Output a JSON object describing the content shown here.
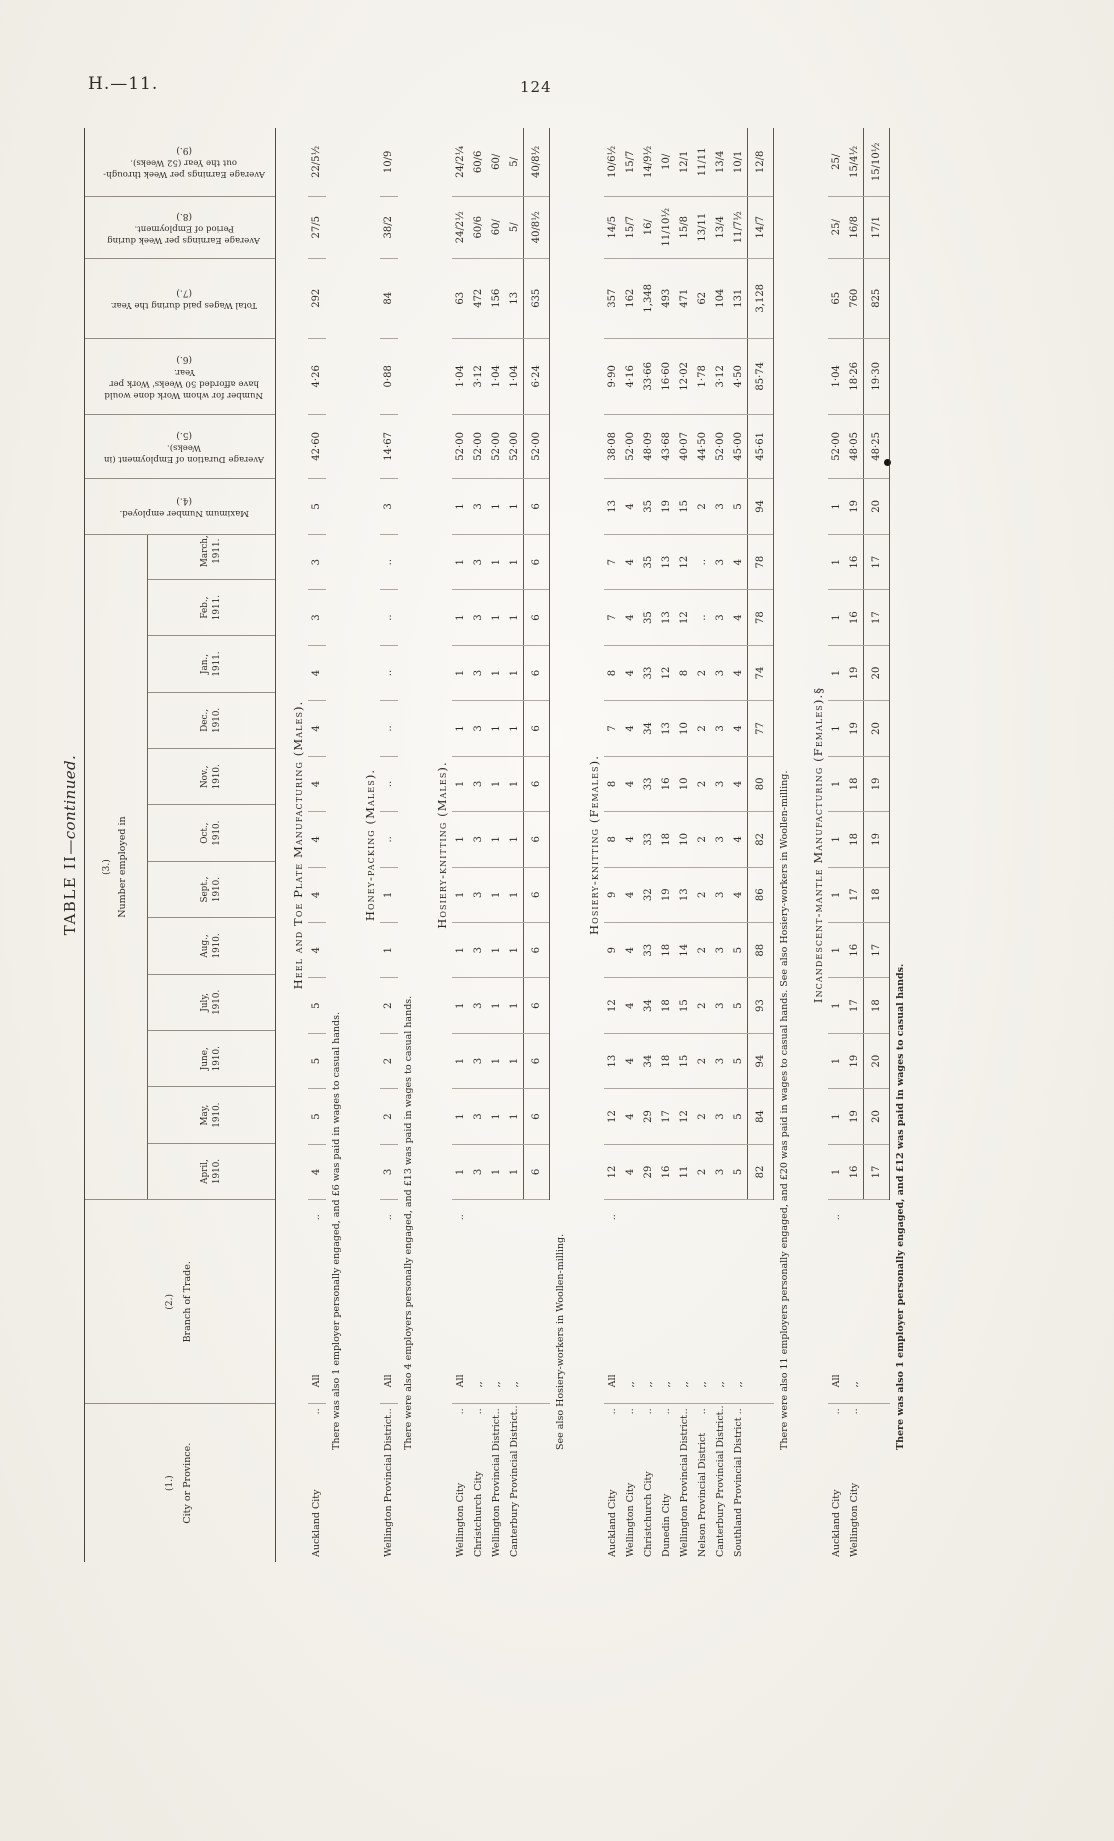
{
  "page": {
    "doc_ref": "H.—11.",
    "page_number": "124",
    "ink_dot_color": "#17130e"
  },
  "table": {
    "title_main": "TABLE II",
    "title_cont": "—continued.",
    "misc": {
      "leader": "..",
      "ditto": ",,"
    },
    "columns": {
      "c1": {
        "num": "(1.)",
        "label": "City or Province."
      },
      "c2": {
        "num": "(2.)",
        "label": "Branch of Trade."
      },
      "c3": {
        "num": "(3.)",
        "label": "Number employed in"
      },
      "c4": {
        "num": "(4.)",
        "label": "Maximum Number employed."
      },
      "c5": {
        "num": "(5.)",
        "label": "Average Duration of Employment (in Weeks)."
      },
      "c6": {
        "num": "(6.)",
        "label": "Number for whom Work done would have afforded 50 Weeks' Work per Year."
      },
      "c7": {
        "num": "(7.)",
        "label": "Total Wages paid during the Year."
      },
      "c8": {
        "num": "(8.)",
        "label": "Average Earnings per Week during Period of Employment."
      },
      "c9": {
        "num": "(9.)",
        "label": "Average Earnings per Week through-out the Year (52 Weeks)."
      }
    },
    "months": [
      {
        "l1": "April,",
        "l2": "1910."
      },
      {
        "l1": "May,",
        "l2": "1910."
      },
      {
        "l1": "June,",
        "l2": "1910."
      },
      {
        "l1": "July,",
        "l2": "1910."
      },
      {
        "l1": "Aug.,",
        "l2": "1910."
      },
      {
        "l1": "Sept.,",
        "l2": "1910."
      },
      {
        "l1": "Oct.,",
        "l2": "1910."
      },
      {
        "l1": "Nov.,",
        "l2": "1910."
      },
      {
        "l1": "Dec.,",
        "l2": "1910."
      },
      {
        "l1": "Jan.,",
        "l2": "1911."
      },
      {
        "l1": "Feb.,",
        "l2": "1911."
      },
      {
        "l1": "March,",
        "l2": "1911."
      }
    ],
    "sections": [
      {
        "title": "Heel and Toe Plate Manufacturing (Males).",
        "rows": [
          {
            "city": "Auckland City",
            "branch": "All",
            "months": [
              "4",
              "5",
              "5",
              "5",
              "4",
              "4",
              "4",
              "4",
              "4",
              "4",
              "3",
              "3"
            ],
            "max": "5",
            "duration": "42·60",
            "fifty": "4·26",
            "wages": "292",
            "earn_period": "27/5",
            "earn_year": "22/5½"
          }
        ],
        "totals": null,
        "note": "There was also 1 employer personally engaged, and £6 was paid in wages to casual hands.",
        "note_bold": false
      },
      {
        "title": "Honey-packing (Males).",
        "rows": [
          {
            "city": "Wellington Provincial District",
            "branch": "All",
            "months": [
              "3",
              "2",
              "2",
              "2",
              "1",
              "1",
              "..",
              "..",
              "..",
              "..",
              "..",
              ".."
            ],
            "max": "3",
            "duration": "14·67",
            "fifty": "0·88",
            "wages": "84",
            "earn_period": "38/2",
            "earn_year": "10/9"
          }
        ],
        "totals": null,
        "note": "There were also 4 employers personally engaged, and £13 was paid in wages to casual hands.",
        "note_bold": false
      },
      {
        "title": "Hosiery-knitting (Males).",
        "rows": [
          {
            "city": "Wellington City",
            "branch": "All",
            "months": [
              "1",
              "1",
              "1",
              "1",
              "1",
              "1",
              "1",
              "1",
              "1",
              "1",
              "1",
              "1"
            ],
            "max": "1",
            "duration": "52·00",
            "fifty": "1·04",
            "wages": "63",
            "earn_period": "24/2½",
            "earn_year": "24/2¼"
          },
          {
            "city": "Christchurch City",
            "branch": ",,",
            "months": [
              "3",
              "3",
              "3",
              "3",
              "3",
              "3",
              "3",
              "3",
              "3",
              "3",
              "3",
              "3"
            ],
            "max": "3",
            "duration": "52·00",
            "fifty": "3·12",
            "wages": "472",
            "earn_period": "60/6",
            "earn_year": "60/6"
          },
          {
            "city": "Wellington Provincial District",
            "branch": ",,",
            "months": [
              "1",
              "1",
              "1",
              "1",
              "1",
              "1",
              "1",
              "1",
              "1",
              "1",
              "1",
              "1"
            ],
            "max": "1",
            "duration": "52·00",
            "fifty": "1·04",
            "wages": "156",
            "earn_period": "60/",
            "earn_year": "60/"
          },
          {
            "city": "Canterbury Provincial District",
            "branch": ",,",
            "months": [
              "1",
              "1",
              "1",
              "1",
              "1",
              "1",
              "1",
              "1",
              "1",
              "1",
              "1",
              "1"
            ],
            "max": "1",
            "duration": "52·00",
            "fifty": "1·04",
            "wages": "13",
            "earn_period": "5/",
            "earn_year": "5/"
          }
        ],
        "totals": {
          "months": [
            "6",
            "6",
            "6",
            "6",
            "6",
            "6",
            "6",
            "6",
            "6",
            "6",
            "6",
            "6"
          ],
          "max": "6",
          "duration": "52·00",
          "fifty": "6·24",
          "wages": "635",
          "earn_period": "40/8½",
          "earn_year": "40/8½"
        },
        "note": "See also Hosiery-workers in Woollen-milling.",
        "note_bold": false
      },
      {
        "title": "Hosiery-knitting (Females).",
        "rows": [
          {
            "city": "Auckland City",
            "branch": "All",
            "months": [
              "12",
              "12",
              "13",
              "12",
              "9",
              "9",
              "8",
              "8",
              "7",
              "8",
              "7",
              "7"
            ],
            "max": "13",
            "duration": "38·08",
            "fifty": "9·90",
            "wages": "357",
            "earn_period": "14/5",
            "earn_year": "10/6½"
          },
          {
            "city": "Wellington City",
            "branch": ",,",
            "months": [
              "4",
              "4",
              "4",
              "4",
              "4",
              "4",
              "4",
              "4",
              "4",
              "4",
              "4",
              "4"
            ],
            "max": "4",
            "duration": "52·00",
            "fifty": "4·16",
            "wages": "162",
            "earn_period": "15/7",
            "earn_year": "15/7"
          },
          {
            "city": "Christchurch City",
            "branch": ",,",
            "months": [
              "29",
              "29",
              "34",
              "34",
              "33",
              "32",
              "33",
              "33",
              "34",
              "33",
              "35",
              "35"
            ],
            "max": "35",
            "duration": "48·09",
            "fifty": "33·66",
            "wages": "1,348",
            "earn_period": "16/",
            "earn_year": "14/9½"
          },
          {
            "city": "Dunedin City",
            "branch": ",,",
            "months": [
              "16",
              "17",
              "18",
              "18",
              "18",
              "19",
              "18",
              "16",
              "13",
              "12",
              "13",
              "13"
            ],
            "max": "19",
            "duration": "43·68",
            "fifty": "16·60",
            "wages": "493",
            "earn_period": "11/10½",
            "earn_year": "10/"
          },
          {
            "city": "Wellington Provincial District",
            "branch": ",,",
            "months": [
              "11",
              "12",
              "15",
              "15",
              "14",
              "13",
              "10",
              "10",
              "10",
              "8",
              "12",
              "12"
            ],
            "max": "15",
            "duration": "40·07",
            "fifty": "12·02",
            "wages": "471",
            "earn_period": "15/8",
            "earn_year": "12/1"
          },
          {
            "city": "Nelson Provincial District",
            "branch": ",,",
            "months": [
              "2",
              "2",
              "2",
              "2",
              "2",
              "2",
              "2",
              "2",
              "2",
              "2",
              "..",
              ".."
            ],
            "max": "2",
            "duration": "44·50",
            "fifty": "1·78",
            "wages": "62",
            "earn_period": "13/11",
            "earn_year": "11/11"
          },
          {
            "city": "Canterbury Provincial District",
            "branch": ",,",
            "months": [
              "3",
              "3",
              "3",
              "3",
              "3",
              "3",
              "3",
              "3",
              "3",
              "3",
              "3",
              "3"
            ],
            "max": "3",
            "duration": "52·00",
            "fifty": "3·12",
            "wages": "104",
            "earn_period": "13/4",
            "earn_year": "13/4"
          },
          {
            "city": "Southland Provincial District",
            "branch": ",,",
            "months": [
              "5",
              "5",
              "5",
              "5",
              "5",
              "4",
              "4",
              "4",
              "4",
              "4",
              "4",
              "4"
            ],
            "max": "5",
            "duration": "45·00",
            "fifty": "4·50",
            "wages": "131",
            "earn_period": "11/7½",
            "earn_year": "10/1"
          }
        ],
        "totals": {
          "months": [
            "82",
            "84",
            "94",
            "93",
            "88",
            "86",
            "82",
            "80",
            "77",
            "74",
            "78",
            "78"
          ],
          "max": "94",
          "duration": "45·61",
          "fifty": "85·74",
          "wages": "3,128",
          "earn_period": "14/7",
          "earn_year": "12/8"
        },
        "note": "There were also 11 employers personally engaged, and £20 was paid in wages to casual hands. See also Hosiery-workers in Woollen-milling.",
        "note_bold": false
      },
      {
        "title": "Incandescent-mantle Manufacturing (Females).§",
        "rows": [
          {
            "city": "Auckland City",
            "branch": "All",
            "months": [
              "1",
              "1",
              "1",
              "1",
              "1",
              "1",
              "1",
              "1",
              "1",
              "1",
              "1",
              "1"
            ],
            "max": "1",
            "duration": "52·00",
            "fifty": "1·04",
            "wages": "65",
            "earn_period": "25/",
            "earn_year": "25/"
          },
          {
            "city": "Wellington City",
            "branch": ",,",
            "months": [
              "16",
              "19",
              "19",
              "17",
              "16",
              "17",
              "18",
              "18",
              "19",
              "19",
              "16",
              "16"
            ],
            "max": "19",
            "duration": "48·05",
            "fifty": "18·26",
            "wages": "760",
            "earn_period": "16/8",
            "earn_year": "15/4½"
          }
        ],
        "totals": {
          "months": [
            "17",
            "20",
            "20",
            "18",
            "17",
            "18",
            "19",
            "19",
            "20",
            "20",
            "17",
            "17"
          ],
          "max": "20",
          "duration": "48·25",
          "fifty": "19·30",
          "wages": "825",
          "earn_period": "17/1",
          "earn_year": "15/10½"
        },
        "note": "There was also 1 employer personally engaged, and £12 was paid in wages to casual hands.",
        "note_bold": true
      }
    ]
  }
}
